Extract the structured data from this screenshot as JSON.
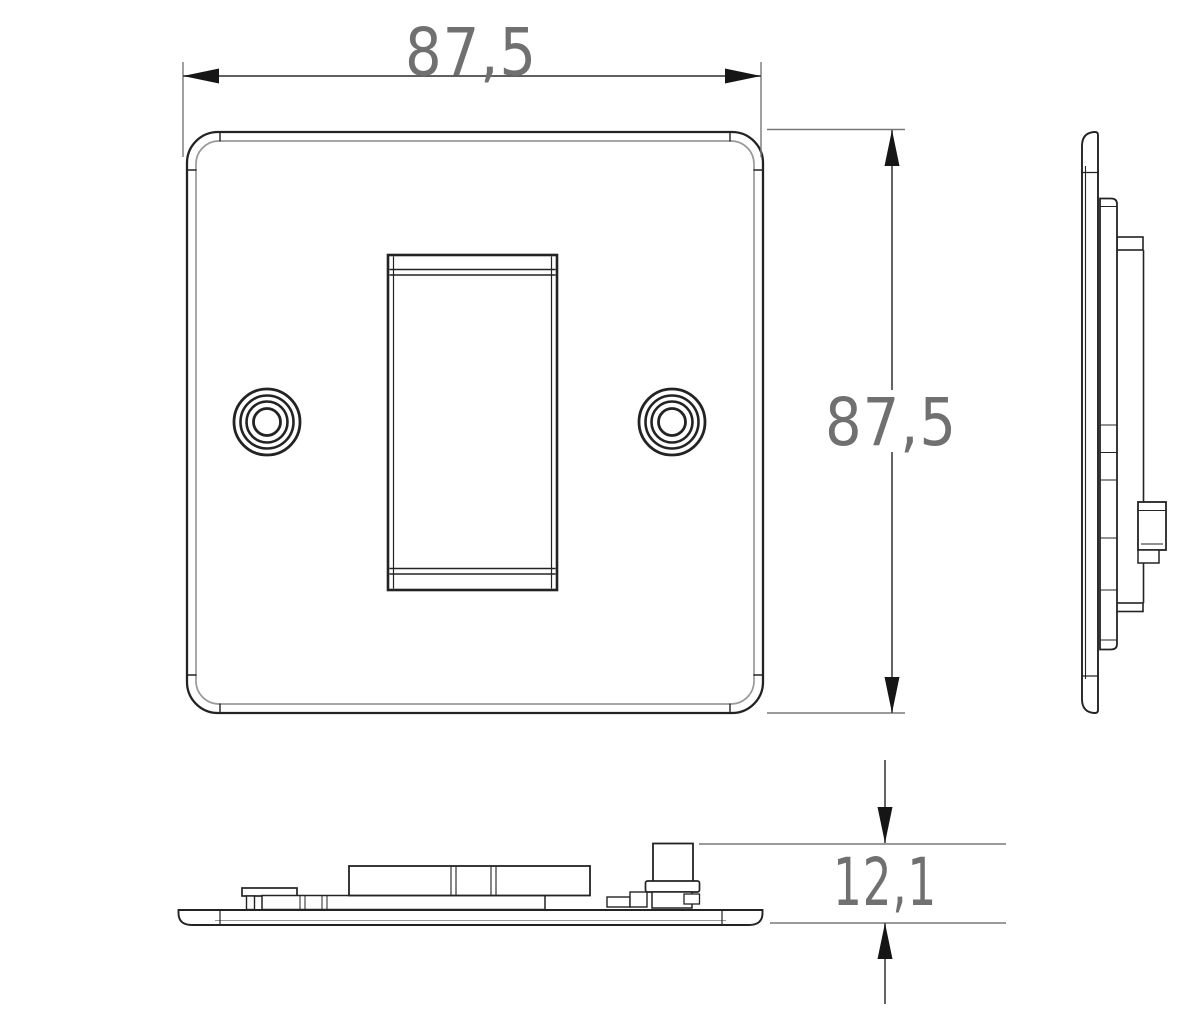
{
  "drawing": {
    "kind": "technical-orthographic-drawing",
    "views": {
      "front": "front-view",
      "side": "side-profile-view",
      "bottom": "bottom-profile-view"
    }
  },
  "dimensions": {
    "plate_width": {
      "label": "87,5"
    },
    "plate_height": {
      "label": "87,5"
    },
    "plate_depth": {
      "label": "12,1"
    }
  },
  "colors": {
    "background": "#ffffff",
    "outline": "#232323",
    "secondary_line": "#9a9a9a",
    "dimension_line": "#4a4a4a",
    "extension_line": "#787878",
    "arrow": "#161616",
    "dimension_text": "#707070"
  }
}
